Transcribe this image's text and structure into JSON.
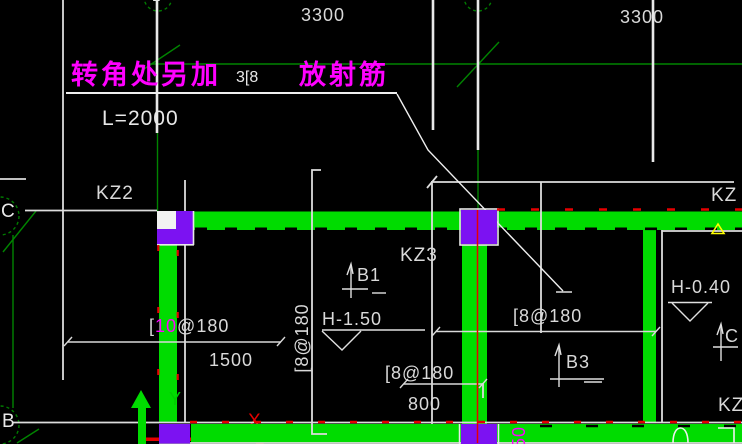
{
  "drawing": {
    "notes": {
      "corner_note_left": "转角处另加",
      "corner_note_size": "3[8",
      "corner_note_right": "放射筋",
      "length_note": "L=2000"
    },
    "dimensions": {
      "span1": "3300",
      "span2": "3300",
      "dim_1500": "1500",
      "dim_800": "800",
      "dim_rotated_50": "50"
    },
    "rebar": {
      "top_left_prefix": "[",
      "top_left_num": "10",
      "top_left_suffix": "@180",
      "vertical": "[8@180",
      "center": "[8@180",
      "lower_left": "[8@180"
    },
    "columns": {
      "kz2": "KZ2",
      "kz3": "KZ3",
      "kz_right": "KZ",
      "kz_bottom_right": "KZ"
    },
    "grid": {
      "axis_c": "C",
      "axis_b": "B",
      "axis_1": "1",
      "axis_2": "2"
    },
    "levels": {
      "h_mid": "H-1.50",
      "h_right": "H-0.40"
    },
    "beam_marks": {
      "b1": "B1",
      "b3": "B3",
      "c_right": "C"
    },
    "ucs": {
      "x": "X",
      "y": "Y"
    },
    "colors": {
      "beam_green": "#00dc00",
      "column_purple": "#7c12f2",
      "note_magenta": "#ff00ff",
      "dim_white": "#d9d9d9",
      "centerline_red": "#e60000",
      "grid_green": "#008400",
      "level_yellow": "#ffff00"
    }
  }
}
